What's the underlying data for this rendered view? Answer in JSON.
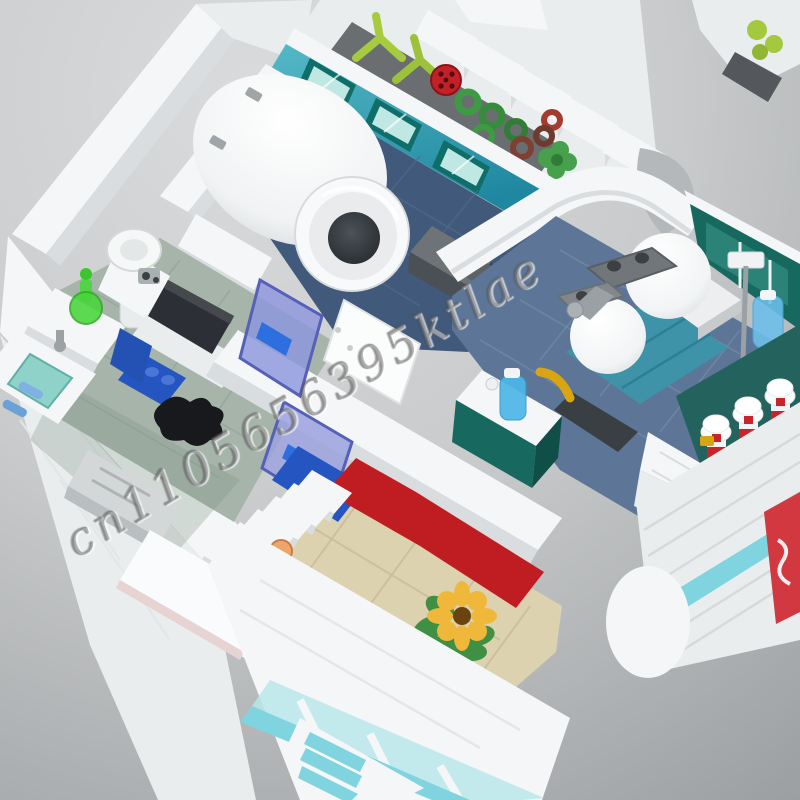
{
  "image": {
    "subject": "LEGO-style modular hospital interior, isometric cutaway product photo"
  },
  "watermark": {
    "text": "cn1105656395ktlae"
  },
  "palette": {
    "background_top": "#d9dadb",
    "background_bottom": "#9da0a3",
    "wall_white": "#f5f6f7",
    "mri_floor_navy": "#41597a",
    "lab_floor_sage": "#a6b4aa",
    "ward_floor_blue": "#5d7697",
    "waiting_floor_tan": "#ddd2b0",
    "teal_wall": "#3aa7b5",
    "teal_dark": "#17695f",
    "bed_teal": "#3e93a8",
    "accent_blue": "#2455c0",
    "accent_red": "#c01d22",
    "chair_dark_red": "#a23a3c",
    "plant_green": "#3f9a44",
    "lime_green": "#a4c93e",
    "sunflower_yellow": "#f0b83a",
    "violet_door": "#8d96dd",
    "storefront_teal": "#7fd4e0"
  }
}
